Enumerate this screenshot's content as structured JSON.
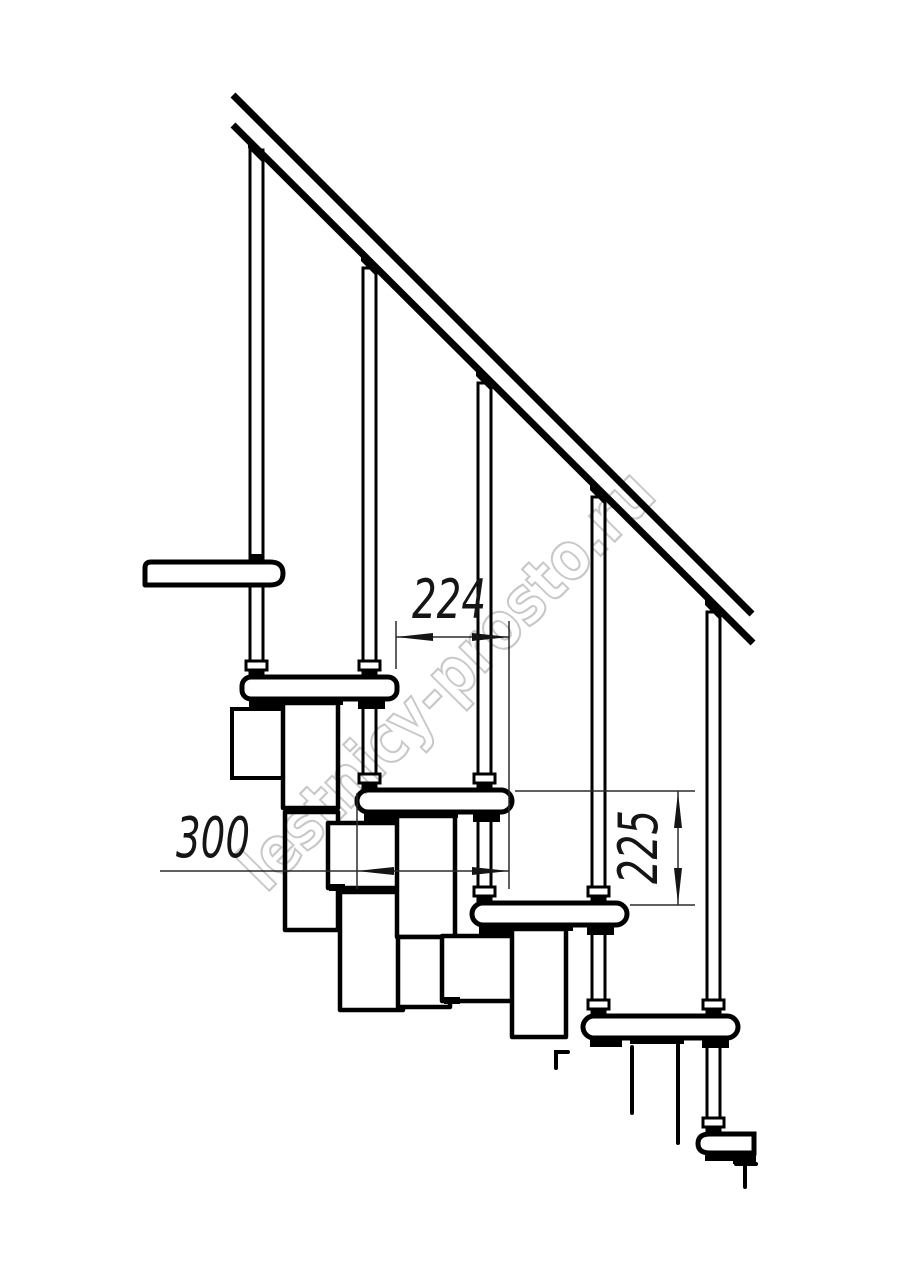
{
  "drawing": {
    "title": "modular-staircase-fragment-side-view",
    "watermark": {
      "text": "lestnicy-prosto.ru",
      "color": "#c2c2c2"
    },
    "dimensions": [
      {
        "id": "step-going",
        "value": "224",
        "unit": "mm",
        "orientation": "horizontal"
      },
      {
        "id": "tread-depth",
        "value": "300",
        "unit": "mm",
        "orientation": "horizontal"
      },
      {
        "id": "riser-height",
        "value": "225",
        "unit": "mm",
        "orientation": "vertical"
      }
    ],
    "counts": {
      "treads": 5,
      "balusters": 5
    },
    "colors": {
      "line": "#000000",
      "dimension_line": "#2b2b2b",
      "background": "#ffffff",
      "watermark": "#c2c2c2"
    }
  }
}
